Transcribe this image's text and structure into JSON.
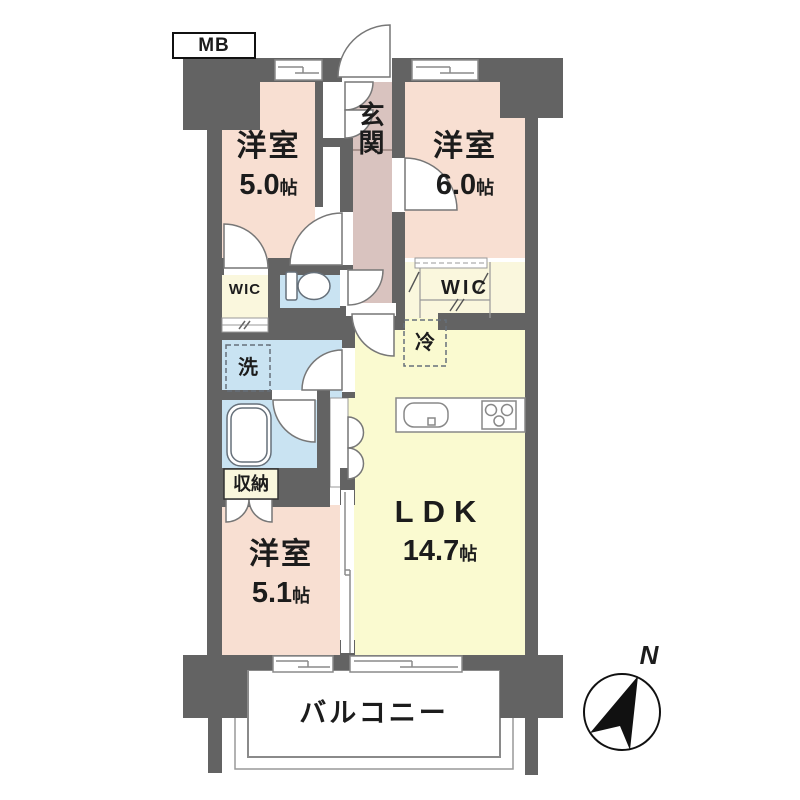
{
  "plan": {
    "meter_box": "MB",
    "entrance": "玄関",
    "bedroom1": {
      "name": "洋室",
      "size": "5.0",
      "unit": "帖"
    },
    "bedroom2": {
      "name": "洋室",
      "size": "6.0",
      "unit": "帖"
    },
    "bedroom3": {
      "name": "洋室",
      "size": "5.1",
      "unit": "帖"
    },
    "ldk": {
      "name": "LDK",
      "size": "14.7",
      "unit": "帖"
    },
    "wic_left": "WIC",
    "wic_right": "WIC",
    "laundry": "洗",
    "fridge": "冷",
    "storage": "収納",
    "balcony": "バルコニー",
    "compass_north": "N"
  },
  "colors": {
    "wall": "#636363",
    "bedroom_floor": "#f8dfd2",
    "entrance_hall_floor": "#d9c3bf",
    "ldk_floor": "#fafad0",
    "wet_area_floor": "#c9e3f2",
    "closet_floor": "#faf7dd",
    "balcony": "#ffffff",
    "line": "#777777",
    "text": "#1c1c1c"
  }
}
